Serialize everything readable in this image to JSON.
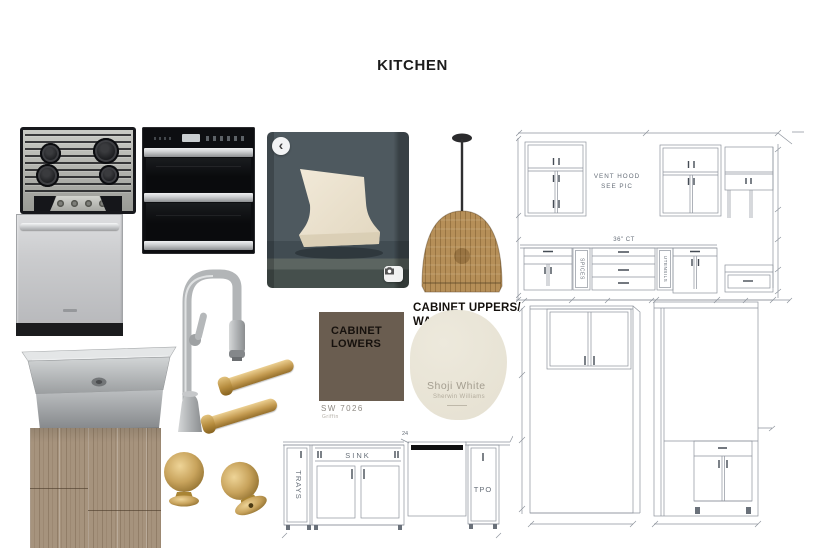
{
  "board": {
    "title": "KITCHEN"
  },
  "colors": {
    "cabinet_lowers_hex": "#6a5d50",
    "cabinet_uppers_hex": "#e9e5d8",
    "brass_hardware_hex": "#c8a45c",
    "drawing_line_hex": "#8d939c"
  },
  "paint": {
    "lowers": {
      "label_line1": "CABINET",
      "label_line2": "LOWERS",
      "code": "SW 7026",
      "name": "Griffin"
    },
    "uppers": {
      "heading_line1": "CABINET UPPERS/",
      "heading_line2": "WALLS",
      "name": "Shoji White",
      "brand": "Sherwin Williams"
    }
  },
  "upper_elevation": {
    "note_line1": "VENT HOOD",
    "note_line2": "SEE PIC",
    "countertop_label": "36\" CT",
    "spices_label": "SPICES",
    "utensils_label": "UTENSILS"
  },
  "base_elevation": {
    "trays_label": "TRAYS",
    "sink_label": "SINK",
    "tpo_label": "TPO",
    "dishwasher_dim": "24"
  },
  "hood_photo": {
    "back_glyph": "‹"
  }
}
